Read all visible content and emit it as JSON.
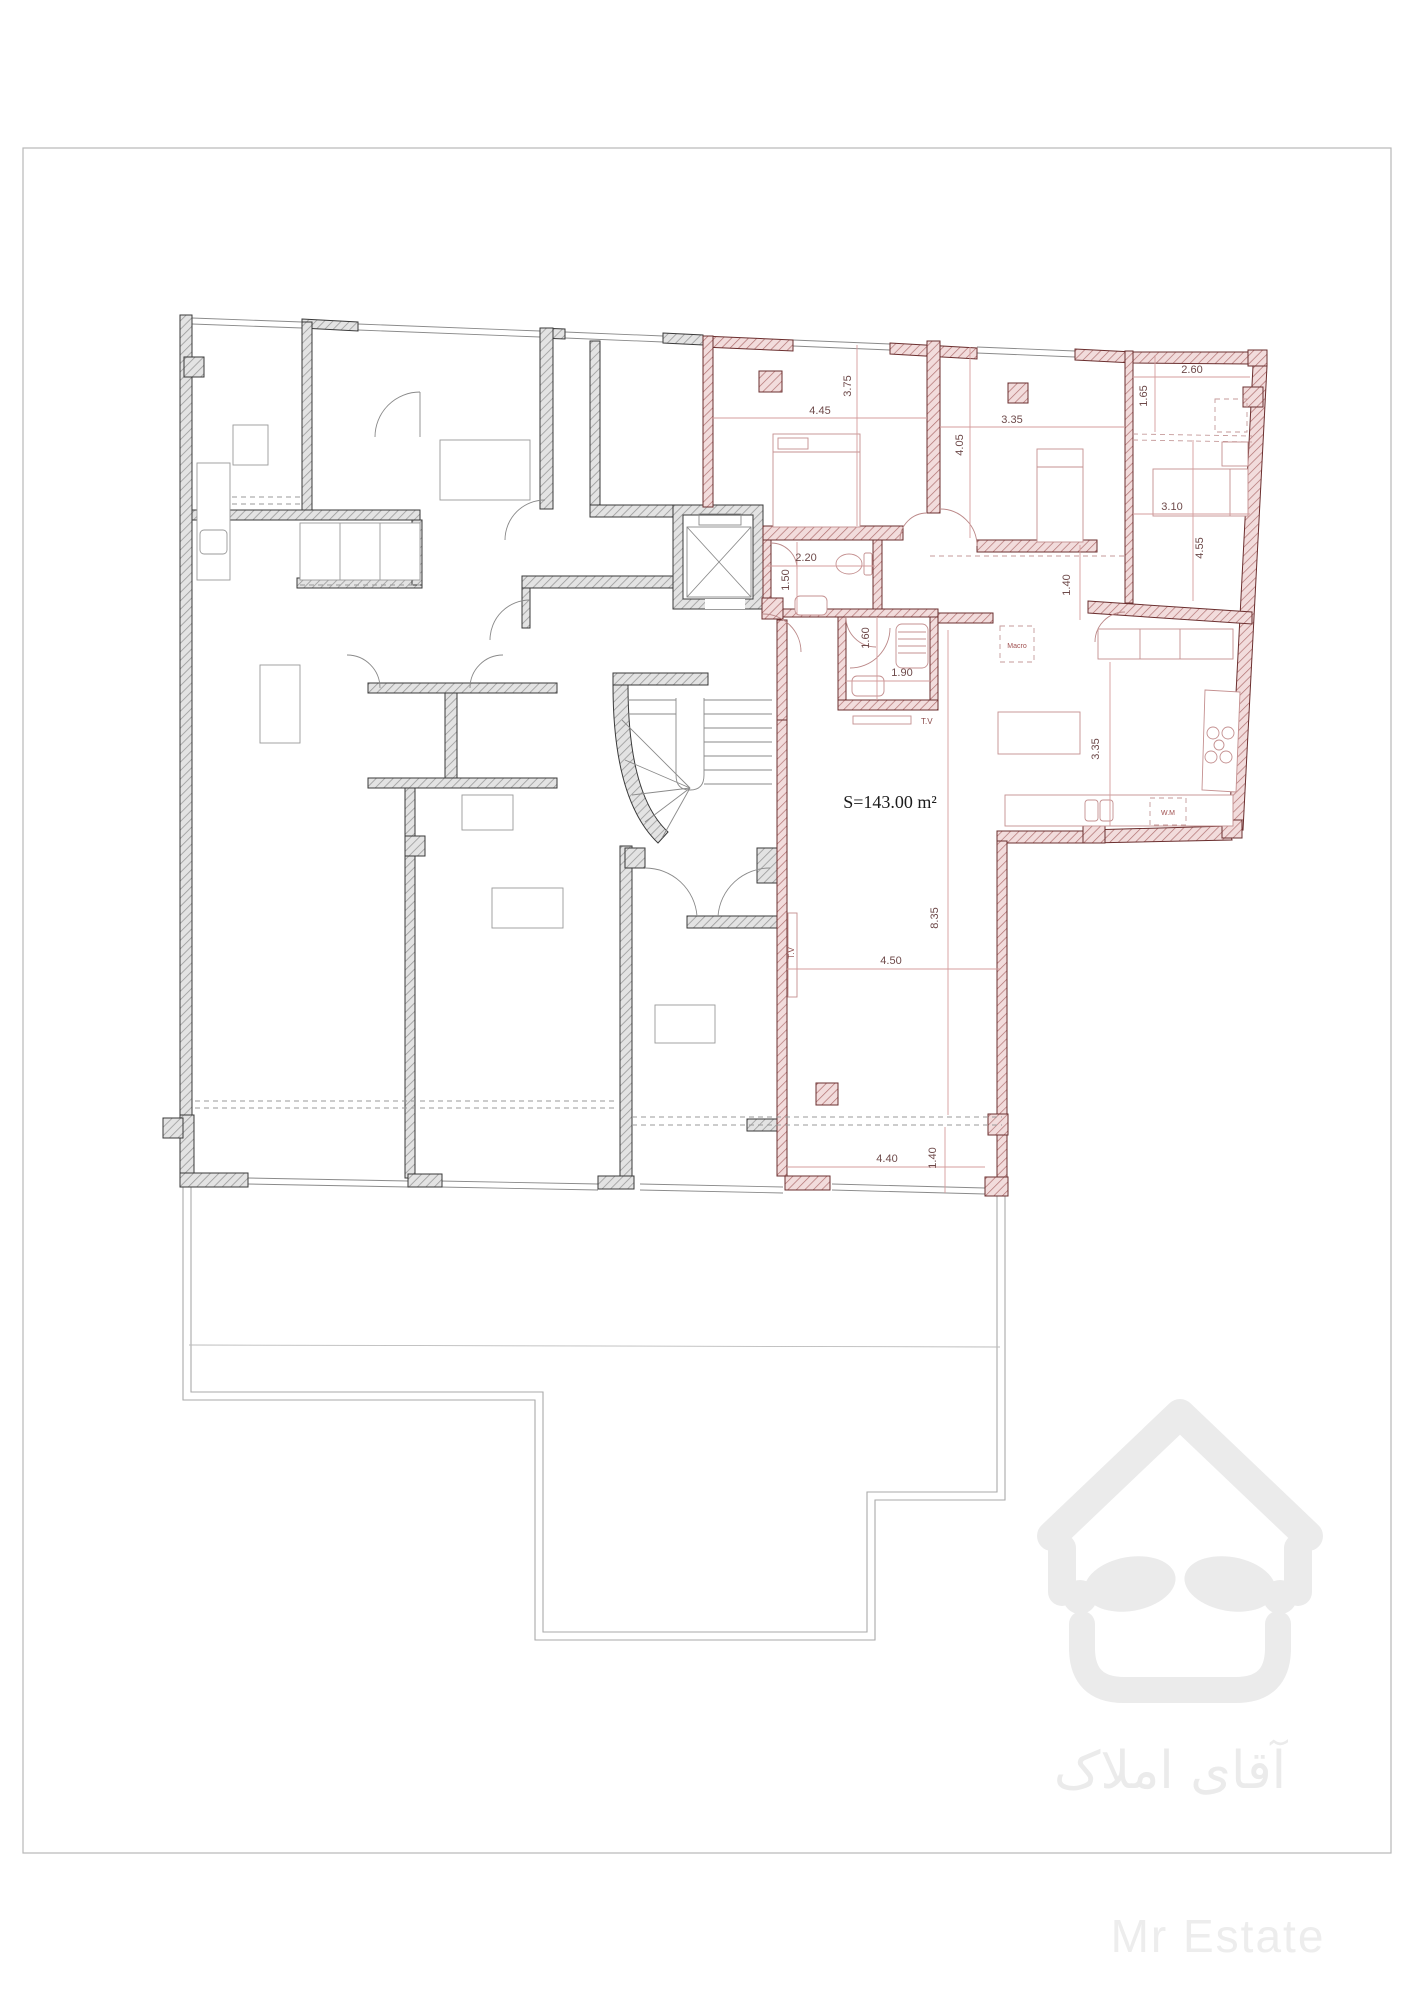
{
  "plan": {
    "area_label": "S=143.00 m²",
    "dimensions": [
      {
        "value": "4.45"
      },
      {
        "value": "3.75"
      },
      {
        "value": "3.35"
      },
      {
        "value": "4.05"
      },
      {
        "value": "2.60"
      },
      {
        "value": "1.65"
      },
      {
        "value": "3.10"
      },
      {
        "value": "4.55"
      },
      {
        "value": "1.40"
      },
      {
        "value": "2.20"
      },
      {
        "value": "1.50"
      },
      {
        "value": "1.60"
      },
      {
        "value": "1.90"
      },
      {
        "value": "3.35"
      },
      {
        "value": "8.35"
      },
      {
        "value": "4.50"
      },
      {
        "value": "4.40"
      },
      {
        "value": "1.40"
      }
    ],
    "labels": {
      "tv_bath": "T.V",
      "tv_living": "T.V",
      "macro": "Macro",
      "washing_machine": "W.M"
    },
    "colors": {
      "wall_gray_hatch": "#9a9a9a",
      "wall_red_hatch": "#b07070",
      "dimension_text": "#6e4a4a",
      "dimension_line": "#d49c9c",
      "watermark": "#ebebeb"
    }
  },
  "watermark": {
    "brand_fa": "آقای املاک",
    "brand_en": "Mr Estate"
  }
}
